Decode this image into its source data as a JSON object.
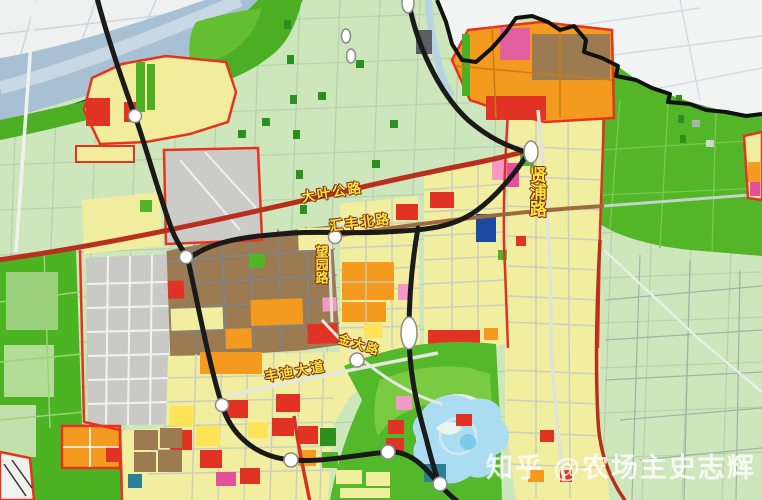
{
  "map": {
    "type": "urban-planning-zoning-map",
    "labels": {
      "road_daye": "大叶公路",
      "road_huifeng": "汇丰北路",
      "road_wangyuan": "望园路",
      "road_xianpu": "贤浦路",
      "road_jinda": "金大路",
      "road_fengdi": "丰迪大道"
    },
    "watermark": "知乎 @农场主史志辉",
    "colors": {
      "rural_light_green": "#cfe6bd",
      "farmland_green": "#4fb327",
      "forest_green": "#55b52c",
      "parcel_yellow": "#f2eea2",
      "parcel_bright_yellow": "#ffe45c",
      "parcel_orange": "#f09a24",
      "parcel_red": "#dc3426",
      "parcel_brown": "#9b7b54",
      "parcel_pink": "#ef9ac4",
      "parcel_magenta": "#e2519a",
      "parcel_blue": "#1d4a9c",
      "parcel_grey": "#c9c9c6",
      "river_blue": "#a9c0d2",
      "lake_blue": "#aedcf0",
      "railway_black": "#1a1a1a",
      "highway_red": "#b5301f",
      "zone_border_red": "#e03422",
      "outside_white": "#f2f4f3",
      "label_yellow": "#ffe43c"
    }
  }
}
